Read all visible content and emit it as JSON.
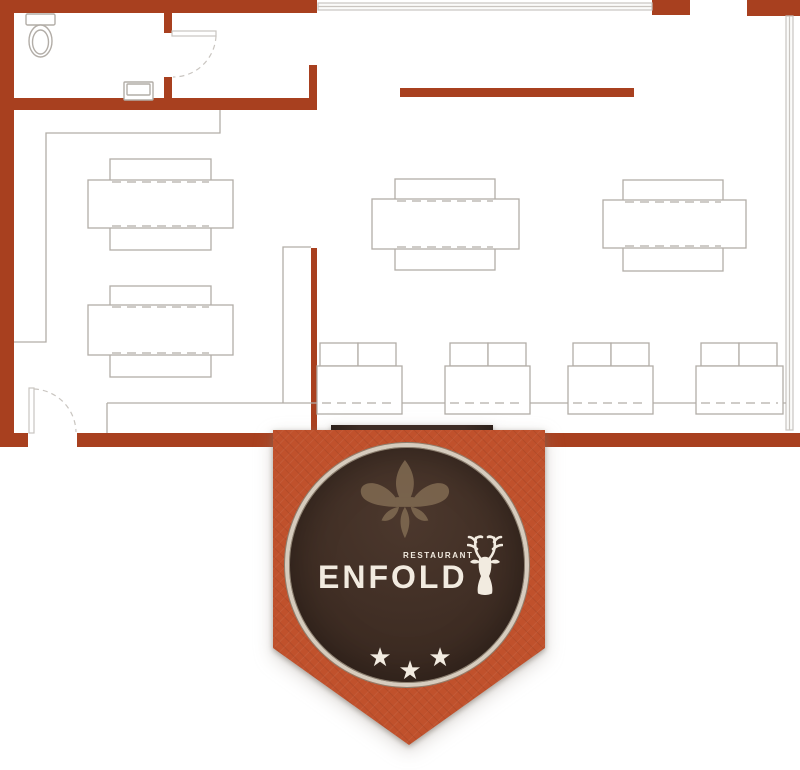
{
  "page": {
    "background": "#ffffff"
  },
  "colors": {
    "wall": "#A8401F",
    "banner_orange": "#C0512C",
    "ribbon_brown": "#3D2C24",
    "circle_brown": "#423027",
    "ring": "#D6CCBE",
    "cream": "#F2EBE0",
    "fleur": "#816B52",
    "furniture_line": "#B2ADA7",
    "window_line": "#C9C5C0"
  },
  "logo": {
    "restaurant_label": "RESTAURANT",
    "name": "ENFOLD",
    "star_count": 3,
    "star_glyph": "★"
  },
  "floor_plan": {
    "table_groups": [
      {
        "table": [
          88,
          180,
          145,
          48
        ],
        "bench_top": [
          110,
          159,
          101,
          23
        ],
        "bench_bottom": [
          110,
          227,
          101,
          23
        ]
      },
      {
        "table": [
          88,
          305,
          145,
          50
        ],
        "bench_top": [
          110,
          286,
          101,
          24
        ],
        "bench_bottom": [
          110,
          353,
          101,
          24
        ]
      },
      {
        "table": [
          372,
          199,
          147,
          50
        ],
        "bench_top": [
          395,
          179,
          100,
          24
        ],
        "bench_bottom": [
          395,
          247,
          100,
          23
        ]
      },
      {
        "table": [
          603,
          200,
          143,
          48
        ],
        "bench_top": [
          623,
          180,
          100,
          23
        ],
        "bench_bottom": [
          623,
          247,
          100,
          24
        ]
      }
    ],
    "booths": [
      {
        "chairs": [
          320,
          343
        ],
        "table": [
          317,
          366,
          85,
          48
        ]
      },
      {
        "chairs": [
          450,
          343
        ],
        "table": [
          445,
          366,
          85,
          48
        ]
      },
      {
        "chairs": [
          573,
          343
        ],
        "table": [
          568,
          366,
          85,
          48
        ]
      },
      {
        "chairs": [
          701,
          343
        ],
        "table": [
          696,
          366,
          87,
          48
        ]
      }
    ],
    "chair_size": [
      38,
      23
    ],
    "booth_seat_line_y": 403
  }
}
